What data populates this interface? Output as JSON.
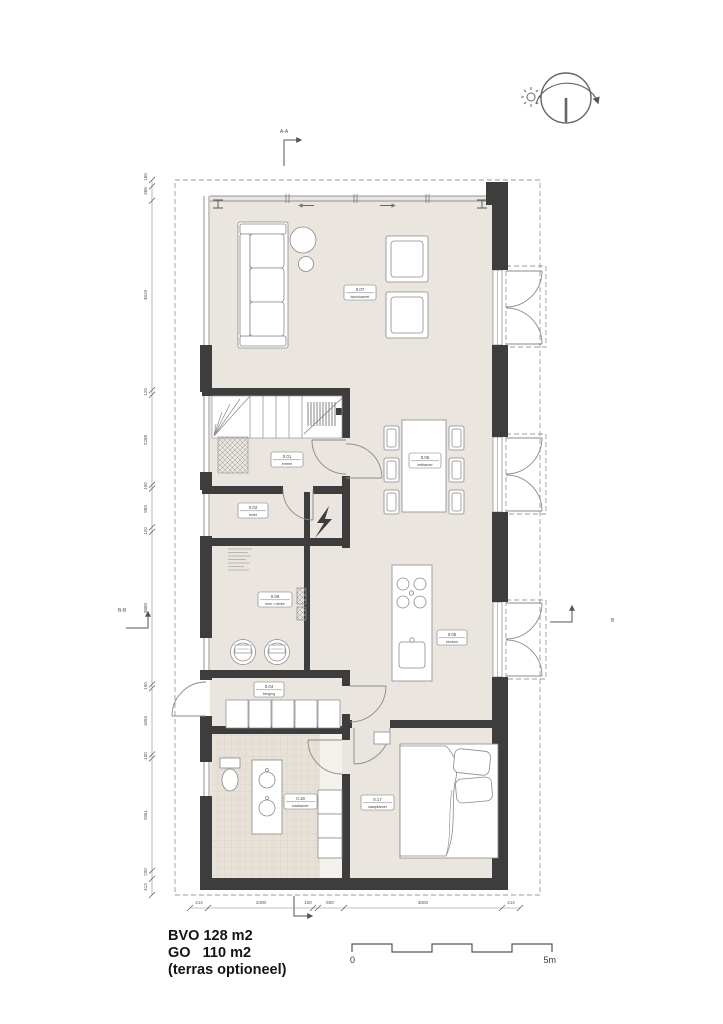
{
  "title": {
    "bvo": "BVO 128 m2",
    "go": "GO   110 m2",
    "note": "(terras optioneel)"
  },
  "scale_bar": {
    "start": "0",
    "end": "5m"
  },
  "sections": {
    "top": "A-A",
    "left": "B-B",
    "right": "B"
  },
  "rooms": {
    "entree": {
      "number": "0.01",
      "name": "entree"
    },
    "toilet": {
      "number": "0.02",
      "name": "toilet"
    },
    "tech": {
      "number": "0.09",
      "name": "tech. ruimte"
    },
    "berging": {
      "number": "0.04",
      "name": "berging"
    },
    "keuken": {
      "number": "0.05",
      "name": "keuken"
    },
    "eetkamer": {
      "number": "0.06",
      "name": "eetkamer"
    },
    "woonkamer": {
      "number": "0.07",
      "name": "woonkamer"
    },
    "badkamer": {
      "number": "0.18",
      "name": "badkamer"
    },
    "slaapkamer": {
      "number": "0.17",
      "name": "slaapkamer"
    }
  },
  "dims": {
    "left": [
      "160",
      "368",
      "4819",
      "120",
      "2288",
      "100",
      "983",
      "120",
      "3880",
      "100",
      "1684",
      "100",
      "2861",
      "200",
      "413"
    ],
    "bottom": [
      "414",
      "2400",
      "100",
      "600",
      "3600",
      "414"
    ]
  },
  "colors": {
    "wall": "#3d3d3d",
    "floor": "#eae5de",
    "line": "#8a8a8a",
    "dash": "#9a9a9a",
    "tile": "#d8d1c6"
  }
}
